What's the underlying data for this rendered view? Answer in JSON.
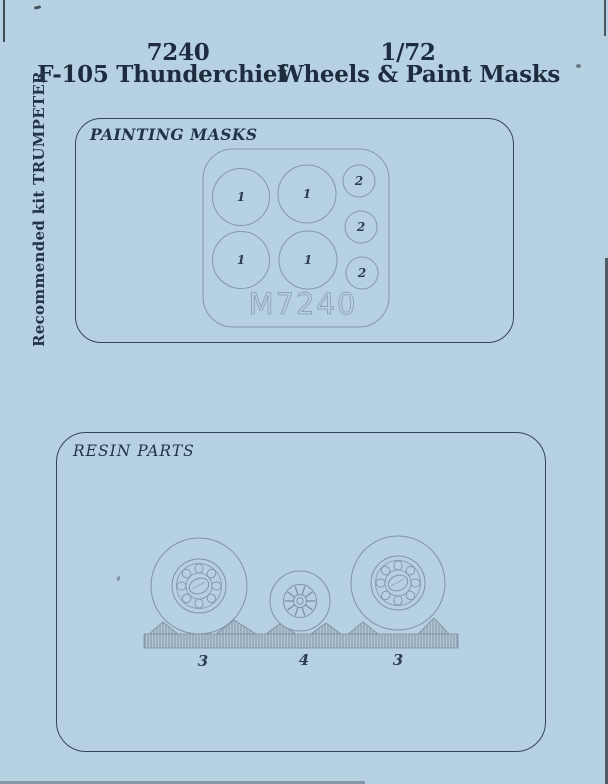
{
  "header": {
    "code": "7240",
    "scale": "1/72",
    "subject": "F-105 Thunderchief",
    "product": "Wheels & Paint Masks"
  },
  "side_note": "Recommended kit TRUMPETER",
  "painting_masks": {
    "label": "PAINTING MASKS",
    "sheet_code": "M7240",
    "large_mask_labels": [
      "1",
      "1",
      "1",
      "1"
    ],
    "small_mask_labels": [
      "2",
      "2",
      "2"
    ]
  },
  "resin_parts": {
    "label": "RESIN PARTS",
    "part_labels": [
      "3",
      "4",
      "3"
    ]
  },
  "colors": {
    "paper": "#b6d1e2",
    "ink": "#1d2c3e",
    "panel_border": "#35465c",
    "figure_line": "#8193a6"
  }
}
